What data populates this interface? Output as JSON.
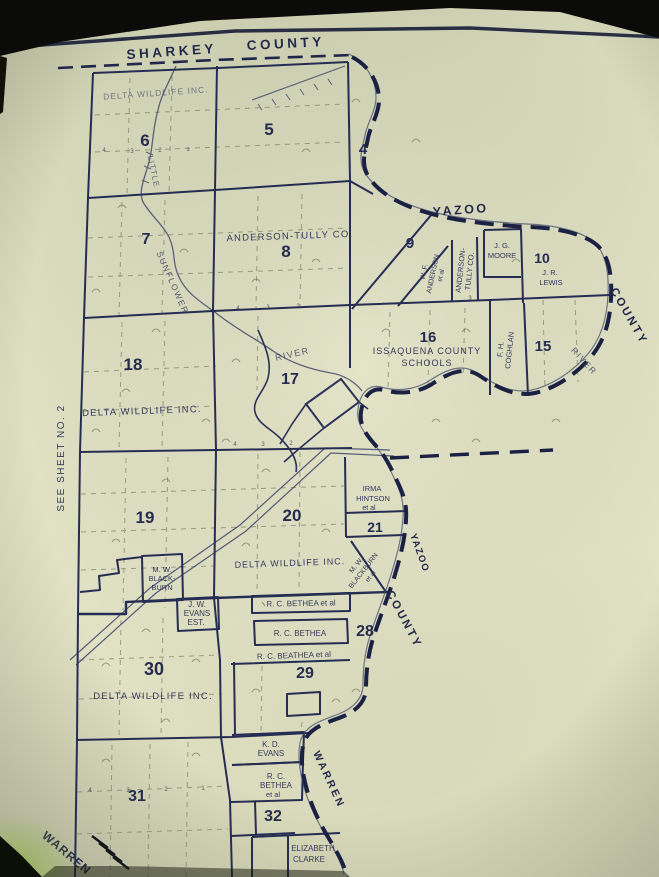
{
  "labels": {
    "sharkey": "SHARKEY",
    "county_top": "COUNTY",
    "yazoo_top": "YAZOO",
    "county_right": "COUNTY",
    "yazoo_mid": "YAZOO",
    "county_mid": "COUNTY",
    "warren_right": "WARREN",
    "warren_corner": "WARREN",
    "see_sheet": "SEE SHEET NO. 2"
  },
  "rivers": {
    "little": "LITTLE",
    "sunflower": "SUNFLOWER",
    "river_mid": "RIVER",
    "river_right": "RIVER"
  },
  "sections": {
    "s4": "4",
    "s5": "5",
    "s6": "6",
    "s7": "7",
    "s8": "8",
    "s9": "9",
    "s10": "10",
    "s15": "15",
    "s16": "16",
    "s17": "17",
    "s18": "18",
    "s19": "19",
    "s20": "20",
    "s21": "21",
    "s28": "28",
    "s29": "29",
    "s30": "30",
    "s31": "31",
    "s32": "32"
  },
  "owners": {
    "delta6": "DELTA WILDLIFE INC.",
    "at8": "ANDERSON-TULLY CO.",
    "wf1": "W. F.",
    "wf2": "ANDERSON",
    "wf3": "et al",
    "ats1": "ANDERSON-",
    "ats2": "TULLY CO.",
    "jg1": "J. G.",
    "jg2": "MOORE",
    "jr1": "J. R.",
    "jr2": "LEWIS",
    "iss1": "ISSAQUENA COUNTY",
    "iss2": "SCHOOLS",
    "fh1": "F. H.",
    "fh2": "COGHLAN",
    "delta18": "DELTA WILDLIFE INC.",
    "irma1": "IRMA",
    "irma2": "HINTSON",
    "irma3": "et al",
    "mwd1": "M. W.",
    "mwd2": "BLACKBURN",
    "mwd3": "et al",
    "delta20": "DELTA WILDLIFE INC.",
    "mwb1": "M. W.",
    "mwb2": "BLACK-",
    "mwb3": "BURN",
    "jw1": "J. W.",
    "jw2": "EVANS",
    "jw3": "EST.",
    "rcb1": "R. C. BETHEA et al",
    "rcb2": "R. C. BETHEA",
    "rcb3": "R. C. BEATHEA et al",
    "delta30": "DELTA WILDLIFE INC.",
    "kd1": "K. D.",
    "kd2": "EVANS",
    "rcb4a": "R. C.",
    "rcb4b": "BETHEA",
    "rcb4c": "et al",
    "eliz1": "ELIZABETH",
    "eliz2": "CLARKE"
  },
  "tiny_numbers": [
    "4",
    "3",
    "2",
    "1",
    "4",
    "3",
    "2",
    "4",
    "3",
    "2",
    "1",
    "4",
    "3",
    "4",
    "3",
    "2"
  ]
}
